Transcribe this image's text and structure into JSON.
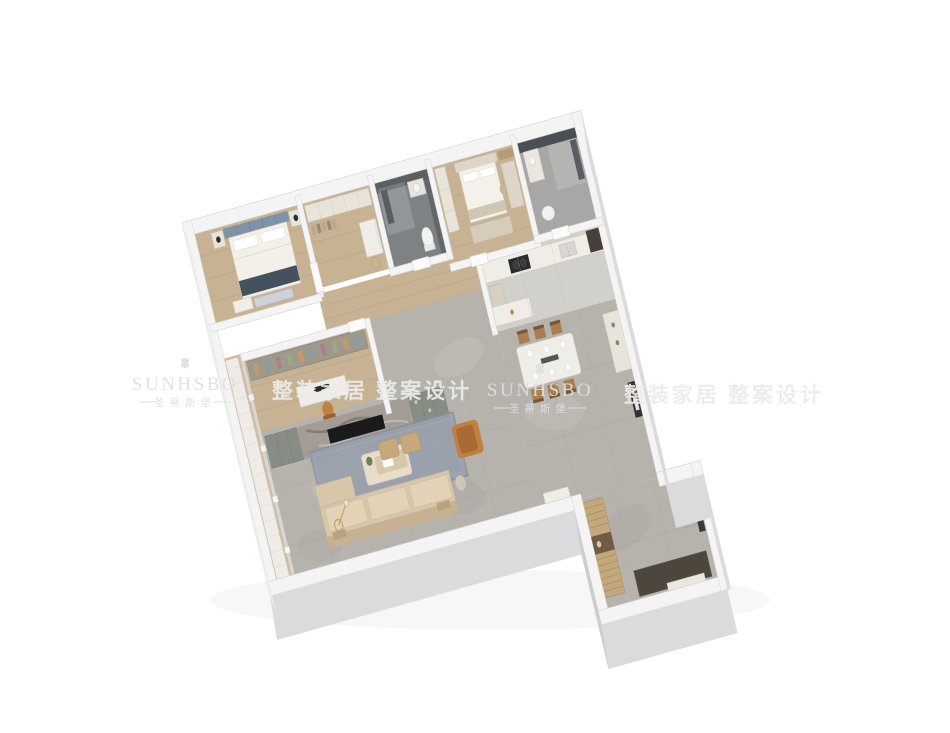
{
  "image": {
    "width": 950,
    "height": 733,
    "background": "#ffffff",
    "description": "3D isometric cutaway render of a furnished apartment floor plan viewed from above"
  },
  "watermark": {
    "brand_en": "SUNHSBO",
    "brand_cn": "圣蒂斯堡",
    "tagline_cn": "整装家居 整案设计",
    "icon": "flower-ornament-icon",
    "color": "#dfdfdf",
    "tagline_color": "#ececec"
  },
  "palette": {
    "bg": "#ffffff",
    "wall": "#f4f4f4",
    "wall-line": "#d4d4d4",
    "face-front": "#dbdbdd",
    "face-side": "#cdcdd0",
    "face-left": "#ecedef",
    "wood": "#c8b294",
    "wood-line": "#b2987a",
    "marble": "#b6b3ad",
    "marble-line": "#a3a09a",
    "marble-light": "#cbc8c2",
    "marble-dark": "#9d9a93",
    "kitchen-floor": "#d2d0ca",
    "bath-dark-floor": "#7e8285",
    "bath-dark-wall": "#5c6063",
    "bath2-floor": "#a7a7a5",
    "green-cab": "#878d84",
    "tv-marble": "#a39d95",
    "tv-streak": "#6a635b",
    "screen-dark": "#1a1a1d",
    "sofa": "#d8c6aa",
    "sofa-seat": "#e2d2b6",
    "sofa-back": "#c6b292",
    "rug": "#9aa1ac",
    "rug-line": "#878e99",
    "tan": "#c0813f",
    "tan-dark": "#a96b33",
    "white-furn": "#f0ede7",
    "furn-line": "#d0cabe",
    "cream": "#e9e4d9",
    "slat": "#c3a87c",
    "slat-line": "#a68c62",
    "mat": "#4d463c",
    "dark": "#2c2c2f",
    "gold": "#c9a36a",
    "curtain": "#f5f5f5",
    "curtain-line": "#e0e0e0",
    "glass": "#dfe6ea",
    "plant": "#6f7f5e",
    "blue-head": "#7f93a6",
    "blue-dark": "#44515e"
  }
}
